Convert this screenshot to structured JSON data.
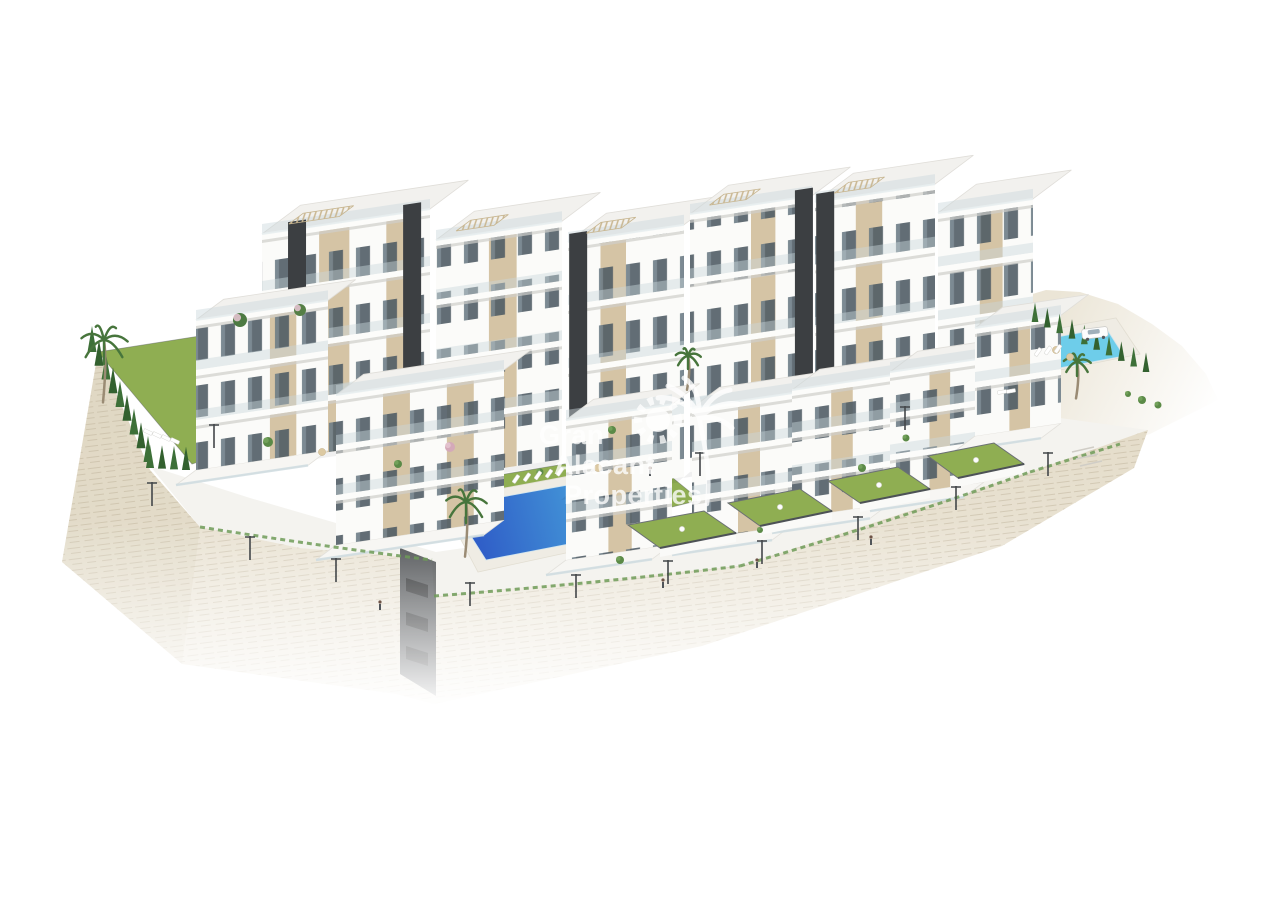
{
  "image": {
    "alt": "Aerial 3D architectural render of a white modern apartment complex with pools, gardens and a stone retaining wall on a hillside",
    "background": "#ffffff"
  },
  "watermark": {
    "line1": "Gran",
    "line2": "Alacant",
    "line3": "Properties",
    "logo": "sun-and-palm-icon",
    "color": "#ffffff",
    "opacity": "0.78"
  },
  "colors": {
    "background": "#ffffff",
    "facade_white": "#fbfbf9",
    "facade_shade": "#e9e8e4",
    "facade_beige": "#d5c4a5",
    "core_dark": "#3c3f42",
    "window_glass": "#4d5a63",
    "roof_light": "#f2f1ee",
    "slab_white": "#fcfcfa",
    "railing_glass": "#c9d6db",
    "lawn_green": "#8fae52",
    "hedge_green": "#33612f",
    "palm_green": "#47753c",
    "pool_deep": "#2b51c4",
    "pool_mid": "#3f8ad4",
    "pool_light": "#55bde8",
    "pool_turquoise_1": "#3fb0da",
    "pool_turquoise_2": "#6ecdea",
    "stone_wall_top": "#e4dcc9",
    "stone_wall_bottom": "#f0ebe0",
    "stone_line": "#b9ad94",
    "terrain_sand": "#ebe5d6",
    "podium": "#f4f3ef"
  },
  "scene": {
    "wall_outline": "98,352 150,470 200,527 300,548 420,558 432,560 434,596 740,566 1030,472 1148,430 1134,468 1002,546 702,646 434,704 396,694 182,664 62,562",
    "wall_left_shade": "98,352 150,470 200,527 182,664 62,562",
    "podium_outline": "150,466 250,498 436,552 700,514 940,432 1016,412 1148,430 1030,472 740,566 434,596 432,560 300,548 200,527",
    "terrain_outline": "1012,300 1046,290 1080,292 1118,304 1152,324 1182,346 1206,374 1218,400 1150,434 1032,472 1000,432 998,368 1006,330",
    "entrance_outline": "400,548 436,562 436,696 400,674",
    "entrance_slots": [
      [
        406,
        578
      ],
      [
        406,
        612
      ],
      [
        406,
        646
      ]
    ],
    "blocks": [
      {
        "name": "back-block-1",
        "x": 262,
        "y": 462,
        "w": 168,
        "h": 228,
        "floors": 4,
        "beige": [
          [
            0.34,
            0.18
          ],
          [
            0.74,
            0.12
          ]
        ],
        "cores": [
          0.155,
          0.84
        ],
        "pergola": 1
      },
      {
        "name": "back-block-2",
        "x": 436,
        "y": 478,
        "w": 126,
        "h": 238,
        "floors": 4,
        "beige": [
          [
            0.42,
            0.22
          ]
        ],
        "cores": [],
        "pergola": 1
      },
      {
        "name": "back-block-3",
        "x": 568,
        "y": 494,
        "w": 116,
        "h": 252,
        "floors": 4,
        "beige": [
          [
            0.28,
            0.22
          ]
        ],
        "cores": [
          0.01
        ],
        "pergola": 1
      },
      {
        "name": "back-block-4",
        "x": 690,
        "y": 472,
        "w": 122,
        "h": 258,
        "floors": 4,
        "beige": [
          [
            0.5,
            0.2
          ]
        ],
        "cores": [
          0.86
        ],
        "pergola": 1
      },
      {
        "name": "back-block-5",
        "x": 815,
        "y": 452,
        "w": 120,
        "h": 250,
        "floors": 4,
        "beige": [
          [
            0.34,
            0.22
          ]
        ],
        "cores": [
          0.01
        ],
        "pergola": 1
      },
      {
        "name": "back-block-6",
        "x": 938,
        "y": 428,
        "w": 95,
        "h": 215,
        "floors": 4,
        "beige": [
          [
            0.44,
            0.24
          ]
        ],
        "cores": [],
        "pergola": 0
      }
    ],
    "villas": [
      {
        "name": "villa-1",
        "x": 196,
        "y": 470,
        "w": 132,
        "h": 150,
        "floors": 3,
        "beige": [
          [
            0.56,
            0.2
          ]
        ],
        "d": 46,
        "terrace": 1
      },
      {
        "name": "villa-2",
        "x": 336,
        "y": 545,
        "w": 168,
        "h": 150,
        "floors": 3,
        "beige": [
          [
            0.28,
            0.16
          ],
          [
            0.66,
            0.16
          ]
        ],
        "d": 46,
        "terrace": 1
      },
      {
        "name": "villa-3",
        "x": 566,
        "y": 560,
        "w": 106,
        "h": 140,
        "floors": 3,
        "beige": [
          [
            0.4,
            0.22
          ]
        ],
        "d": 46,
        "terrace": 1
      },
      {
        "name": "villa-4",
        "x": 692,
        "y": 540,
        "w": 100,
        "h": 132,
        "floors": 3,
        "beige": [
          [
            0.46,
            0.22
          ]
        ],
        "d": 46,
        "terrace": 1
      },
      {
        "name": "villa-5",
        "x": 792,
        "y": 518,
        "w": 98,
        "h": 128,
        "floors": 3,
        "beige": [
          [
            0.4,
            0.22
          ]
        ],
        "d": 46,
        "terrace": 1
      },
      {
        "name": "villa-6",
        "x": 890,
        "y": 496,
        "w": 94,
        "h": 124,
        "floors": 3,
        "beige": [
          [
            0.42,
            0.22
          ]
        ],
        "d": 46,
        "terrace": 1
      },
      {
        "name": "villa-7",
        "x": 975,
        "y": 436,
        "w": 86,
        "h": 108,
        "floors": 2,
        "beige": [
          [
            0.4,
            0.24
          ]
        ],
        "d": 46,
        "terrace": 1
      }
    ],
    "lawns": [
      {
        "name": "left-garden-lawn",
        "pts": "98,352 238,330 332,418 192,464"
      },
      {
        "name": "pool-north-lawn",
        "pts": "470,480 600,458 622,472 492,496"
      },
      {
        "name": "pool-east-lawn",
        "pts": "612,486 668,474 700,500 644,514"
      },
      {
        "name": "right-pool-lawn",
        "pts": "1008,376 1046,369 1056,384 1018,391"
      },
      {
        "name": "roof-garden-right",
        "pts": "976,388 1038,376 1058,391 996,404"
      }
    ],
    "gardens": [
      {
        "name": "garden-1",
        "pts": [
          [
            628,
            525
          ],
          [
            704,
            511
          ],
          [
            736,
            533
          ],
          [
            660,
            548
          ]
        ]
      },
      {
        "name": "garden-2",
        "pts": [
          [
            728,
            503
          ],
          [
            800,
            489
          ],
          [
            832,
            511
          ],
          [
            760,
            526
          ]
        ]
      },
      {
        "name": "garden-3",
        "pts": [
          [
            828,
            481
          ],
          [
            898,
            467
          ],
          [
            930,
            489
          ],
          [
            860,
            503
          ]
        ]
      },
      {
        "name": "garden-4",
        "pts": [
          [
            928,
            456
          ],
          [
            994,
            443
          ],
          [
            1024,
            464
          ],
          [
            958,
            478
          ]
        ]
      }
    ],
    "decks": [
      {
        "name": "main-pool-deck",
        "pts": "440,500 634,464 672,530 478,572"
      },
      {
        "name": "right-pool-deck",
        "pts": "1016,336 1116,318 1140,354 1040,374"
      }
    ],
    "pools": [
      {
        "name": "small-left-pool",
        "pts": "207,370 262,362 276,392 221,400",
        "grad": "g-small"
      },
      {
        "name": "main-pool",
        "pts": "452,506 618,476 652,528 486,560",
        "grad": "g-big"
      },
      {
        "name": "right-pool",
        "pts": "1030,342 1106,328 1124,356 1048,370",
        "grad": "g-small"
      }
    ],
    "beach_entry": "600,505 652,528 614,540",
    "hedges": [
      {
        "x1": 92,
        "y1": 352,
        "x2": 148,
        "y2": 462,
        "n": 9,
        "s": 1
      },
      {
        "x1": 150,
        "y1": 468,
        "x2": 186,
        "y2": 470,
        "n": 4,
        "s": 0.9
      },
      {
        "x1": 1035,
        "y1": 322,
        "x2": 1146,
        "y2": 372,
        "n": 10,
        "s": 0.75
      }
    ],
    "palms": [
      {
        "x": 104,
        "y": 340,
        "s": 1.2
      },
      {
        "x": 466,
        "y": 502,
        "s": 1.05
      },
      {
        "x": 688,
        "y": 356,
        "s": 0.65
      },
      {
        "x": 1077,
        "y": 362,
        "s": 0.7
      }
    ],
    "shrubs": [
      [
        268,
        442,
        5
      ],
      [
        398,
        464,
        4
      ],
      [
        450,
        447,
        5,
        "#d4a9b9"
      ],
      [
        612,
        430,
        4
      ],
      [
        240,
        320,
        7,
        "#4d7a42"
      ],
      [
        300,
        310,
        6,
        "#557f46"
      ],
      [
        862,
        468,
        4
      ],
      [
        906,
        438,
        3.5
      ],
      [
        1142,
        400,
        4
      ],
      [
        1158,
        405,
        3.5
      ],
      [
        1128,
        394,
        3
      ],
      [
        620,
        560,
        4
      ],
      [
        540,
        472,
        3.5
      ],
      [
        760,
        530,
        3
      ]
    ],
    "parasols": [
      [
        1056,
        350
      ],
      [
        1070,
        357
      ],
      [
        598,
        468
      ],
      [
        322,
        452
      ]
    ],
    "loungers": [
      {
        "x": 516,
        "y": 479,
        "dx": 11,
        "dy": -1.8,
        "n": 5,
        "a": -55
      },
      {
        "x": 148,
        "y": 432,
        "dx": 9,
        "dy": 3,
        "n": 4,
        "a": 25
      },
      {
        "x": 1038,
        "y": 352,
        "dx": 10,
        "dy": -1.6,
        "n": 3,
        "a": -55
      },
      {
        "x": 1002,
        "y": 392,
        "dx": 9,
        "dy": -1,
        "n": 2,
        "a": -10
      }
    ],
    "lamps": [
      [
        250,
        560
      ],
      [
        336,
        582
      ],
      [
        470,
        606
      ],
      [
        576,
        598
      ],
      [
        668,
        584
      ],
      [
        762,
        564
      ],
      [
        858,
        540
      ],
      [
        956,
        510
      ],
      [
        1048,
        476
      ],
      [
        152,
        506
      ],
      [
        214,
        448
      ],
      [
        700,
        476
      ],
      [
        905,
        430
      ]
    ],
    "people": [
      [
        663,
        588
      ],
      [
        757,
        568
      ],
      [
        871,
        545
      ],
      [
        380,
        610
      ],
      [
        650,
        476
      ]
    ],
    "fringe": [
      "M200,527 Q320,546 432,560",
      "M434,596 Q590,584 740,566",
      "M740,566 Q890,522 1030,472",
      "M1030,472 L1120,444"
    ],
    "stairs": [
      "M1072,452 l22,-5",
      "M1076,459 l22,-5",
      "M1080,466 l22,-5"
    ]
  }
}
